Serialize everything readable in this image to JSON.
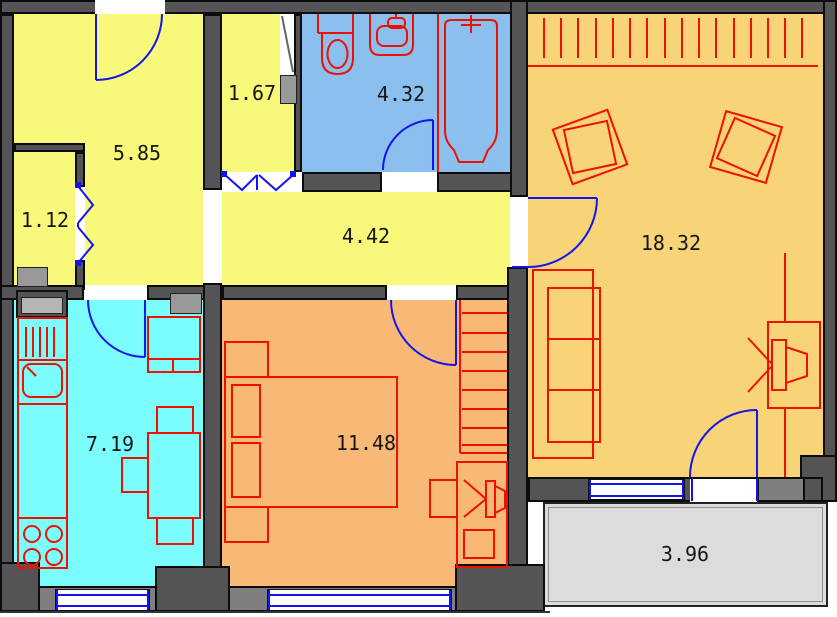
{
  "plan": {
    "rooms": [
      {
        "name": "entrance-hall",
        "area": "5.85",
        "color": "#f8f87a"
      },
      {
        "name": "closet",
        "area": "1.12",
        "color": "#f8f87a"
      },
      {
        "name": "storage",
        "area": "1.67",
        "color": "#f8f87a"
      },
      {
        "name": "bathroom",
        "area": "4.32",
        "color": "#8abfee"
      },
      {
        "name": "corridor",
        "area": "4.42",
        "color": "#f8f87a"
      },
      {
        "name": "kitchen",
        "area": "7.19",
        "color": "#7cfdfd"
      },
      {
        "name": "bedroom",
        "area": "11.48",
        "color": "#f8b876"
      },
      {
        "name": "living-room",
        "area": "18.32",
        "color": "#f8d377"
      },
      {
        "name": "balcony",
        "area": "3.96",
        "color": "#dcdcdc"
      }
    ],
    "colors": {
      "wall": "#545456",
      "wall_face": "#7f7f7f",
      "furniture": "#ee1100",
      "doors_windows": "#1414ee",
      "outline": "#0c0c0c"
    }
  }
}
